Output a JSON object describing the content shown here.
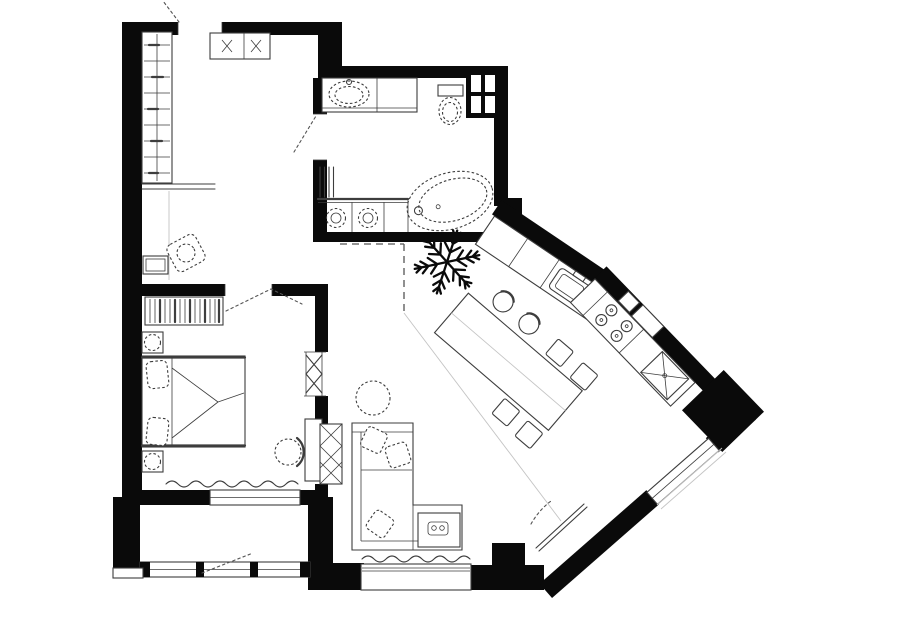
{
  "document": {
    "type": "apartment floor plan",
    "style": "black and white architectural line drawing, no text labels",
    "canvas": {
      "width": 900,
      "height": 623
    }
  },
  "colors": {
    "background": "#ffffff",
    "wall": "#0a0a0a",
    "line": "#3d3d3d",
    "light_line": "#c4c4c4",
    "dash": "#555555"
  },
  "rooms": [
    {
      "name": "entry-hall",
      "features": [
        "entry-door-opening",
        "wardrobe-with-hanger-rod",
        "console-shelf",
        "entry-cabinet-with-cross-marks",
        "armchair",
        "side-table",
        "door-swing-dashes"
      ]
    },
    {
      "name": "bathroom",
      "features": [
        "vanity-counter-with-sink",
        "toilet",
        "ventilation-shaft-grid",
        "radiator",
        "washer-and-dryer-under-counter",
        "freestanding-oval-bathtub",
        "door-to-hall"
      ]
    },
    {
      "name": "bedroom",
      "features": [
        "dresser-striped",
        "double-bed-with-pillows",
        "nightstand-with-lamp-x2",
        "round-chair",
        "wall-desk",
        "hatched-duct",
        "sliding-door-symbol",
        "window-with-wavy-curtain"
      ]
    },
    {
      "name": "living-dining-kitchen",
      "features": [
        "snowflake-symbol",
        "dashed-zone-boundary",
        "floor-divider-line",
        "dining-table-rotated",
        "round-back-chair-x2",
        "square-chair-x4",
        "corner-sofa-with-pillows",
        "sofa-end-table-with-tray",
        "round-coffee-table-dashed",
        "bay-window-with-wavy-curtain",
        "terrace-door-leaf",
        "diagonal-kitchen-counter",
        "kitchen-sink-unit",
        "cooktop-4-burners",
        "refrigerator-x-square",
        "wall-niche-windows"
      ]
    },
    {
      "name": "loggia-balcony",
      "features": [
        "glazing-band-with-mullions",
        "door-swing-dashes"
      ]
    }
  ],
  "symbols": {
    "snowflake-icon": "six-armed branched snowflake drawn in plan center",
    "door_swing": "dotted straight chords at door openings",
    "windows": "double thin lines set in white wall gaps"
  },
  "counts": {
    "window_sections": 5,
    "door_openings": 6,
    "rooms": 5
  }
}
